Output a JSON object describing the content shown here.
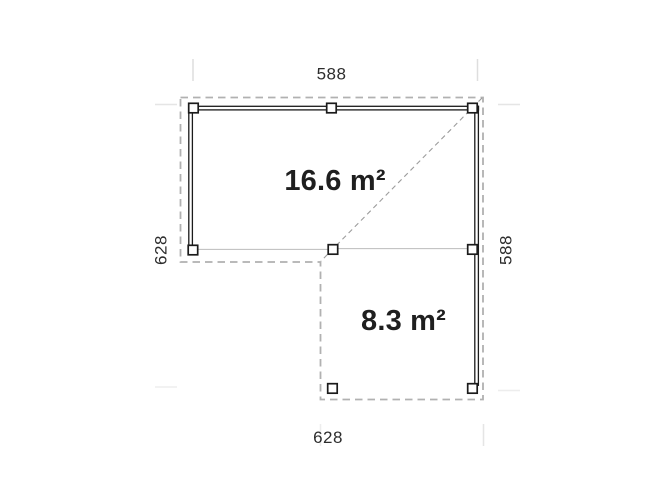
{
  "diagram": {
    "dimensions": {
      "top": "588",
      "bottom": "628",
      "left": "628",
      "right": "588"
    },
    "areas": {
      "large": "16.6 m²",
      "small": "8.3 m²"
    },
    "colors": {
      "wall": "#1b1b1b",
      "outline_dash": "#b1b1b1",
      "diagonal_dash": "#9c9c9c",
      "beam": "#bcbcbc",
      "tick": "#dedede",
      "text": "#2d2d2d",
      "area_text": "#1f1f1f",
      "background": "#ffffff"
    }
  }
}
